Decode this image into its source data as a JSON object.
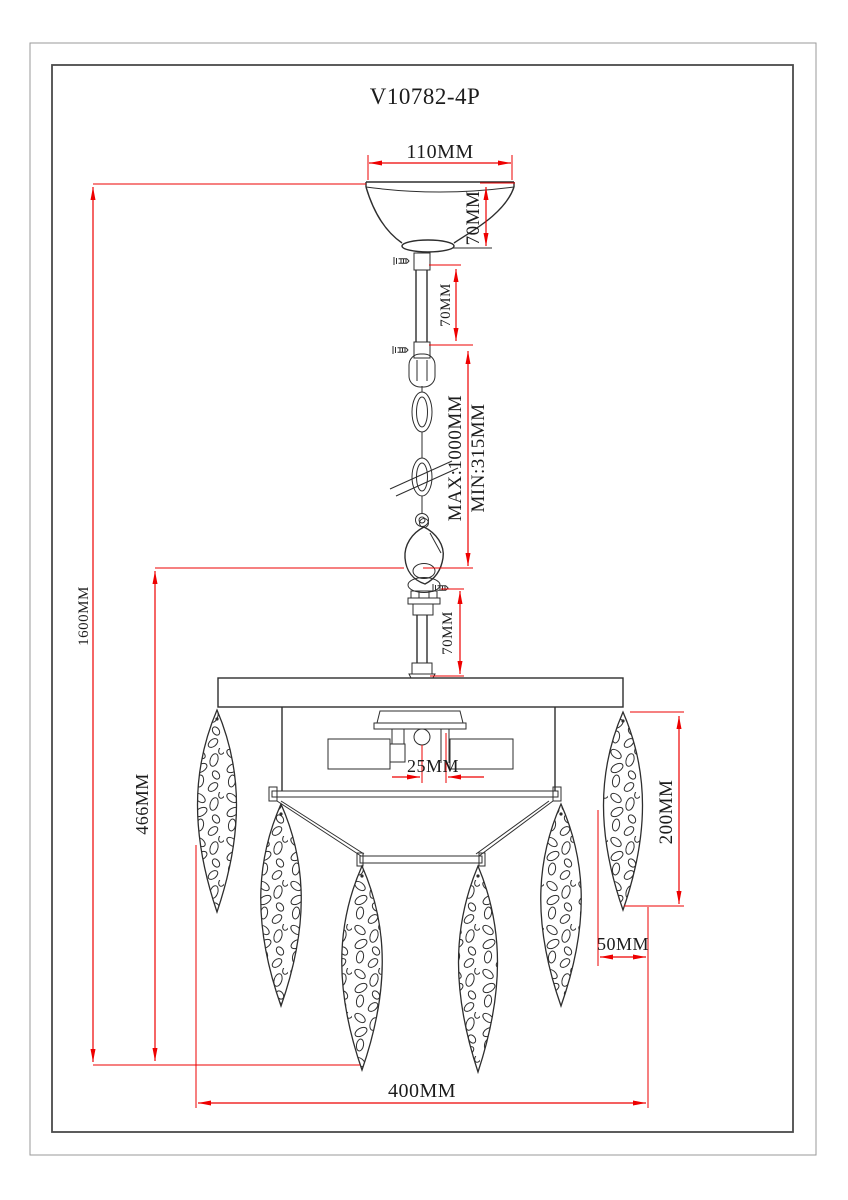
{
  "title": "V10782-4P",
  "dims": {
    "canopy_width": "110MM",
    "canopy_height": "70MM",
    "upper_rod_length": "70MM",
    "chain_max": "MAX:1000MM",
    "chain_min": "MIN:315MM",
    "lower_rod_length": "70MM",
    "overall_height": "1600MM",
    "body_height": "466MM",
    "socket_offset": "25MM",
    "leaf_length": "200MM",
    "leaf_width": "50MM",
    "body_width": "400MM"
  },
  "colors": {
    "dimension_line": "#ee0000",
    "drawing_line": "#2e2e2e",
    "background": "#ffffff"
  }
}
